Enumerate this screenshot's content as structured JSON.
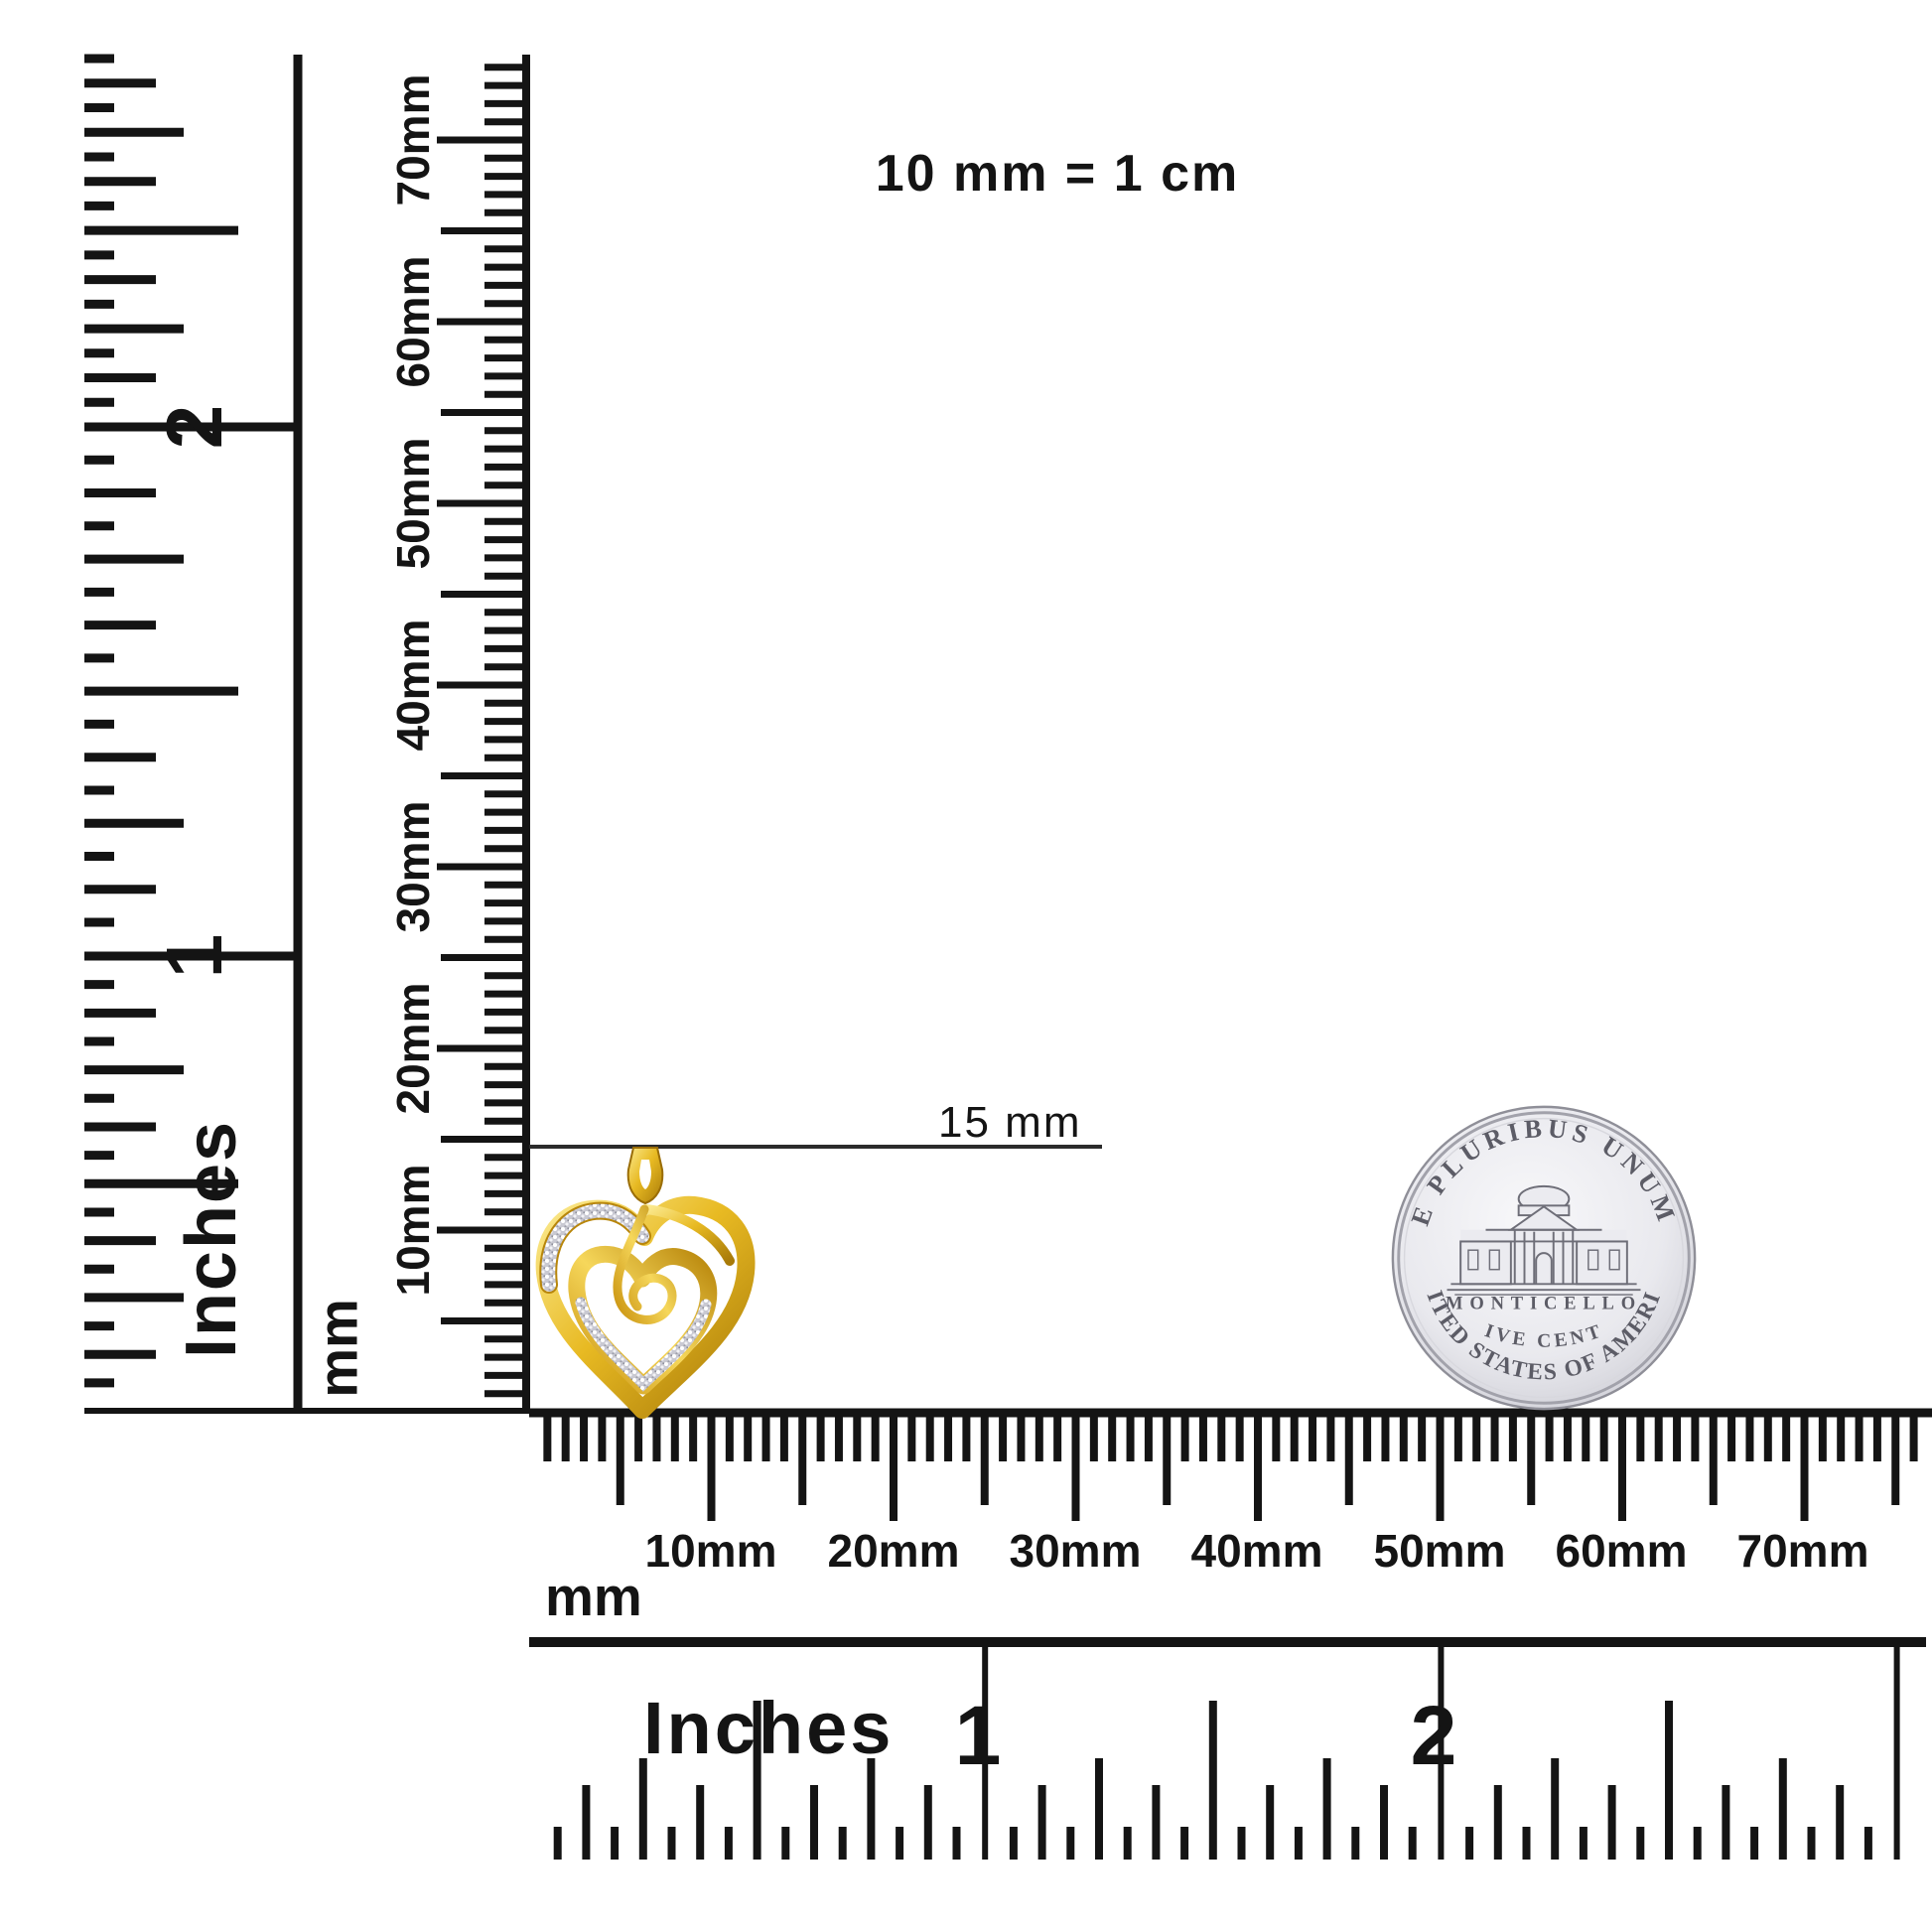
{
  "title_note": {
    "text": "10 mm = 1 cm"
  },
  "annotation": {
    "pendant_size_label": "15 mm"
  },
  "rulers": {
    "left_inch": {
      "unit": "Inches",
      "labels": [
        "2",
        "1"
      ]
    },
    "left_mm": {
      "unit": "mm",
      "labels": [
        "70mm",
        "60mm",
        "50mm",
        "40mm",
        "30mm",
        "20mm",
        "10mm"
      ]
    },
    "bottom_mm": {
      "unit": "mm",
      "labels": [
        "10mm",
        "20mm",
        "30mm",
        "40mm",
        "50mm",
        "60mm",
        "70mm"
      ]
    },
    "bottom_inch": {
      "unit": "Inches",
      "labels": [
        "1",
        "2"
      ]
    }
  },
  "coin": {
    "legend_top": "E PLURIBUS UNUM",
    "building_label": "MONTICELLO",
    "denomination": "FIVE CENTS",
    "legend_bottom": "UNITED STATES OF AMERICA"
  },
  "colors": {
    "ink": "#141414",
    "gold": "#e0ac1b",
    "gold_light": "#f9e286",
    "gold_dark": "#a87a08",
    "silver_body": "#e9e9ee",
    "silver_rim": "#9c9ca4",
    "pave": "#c9c9d2"
  }
}
